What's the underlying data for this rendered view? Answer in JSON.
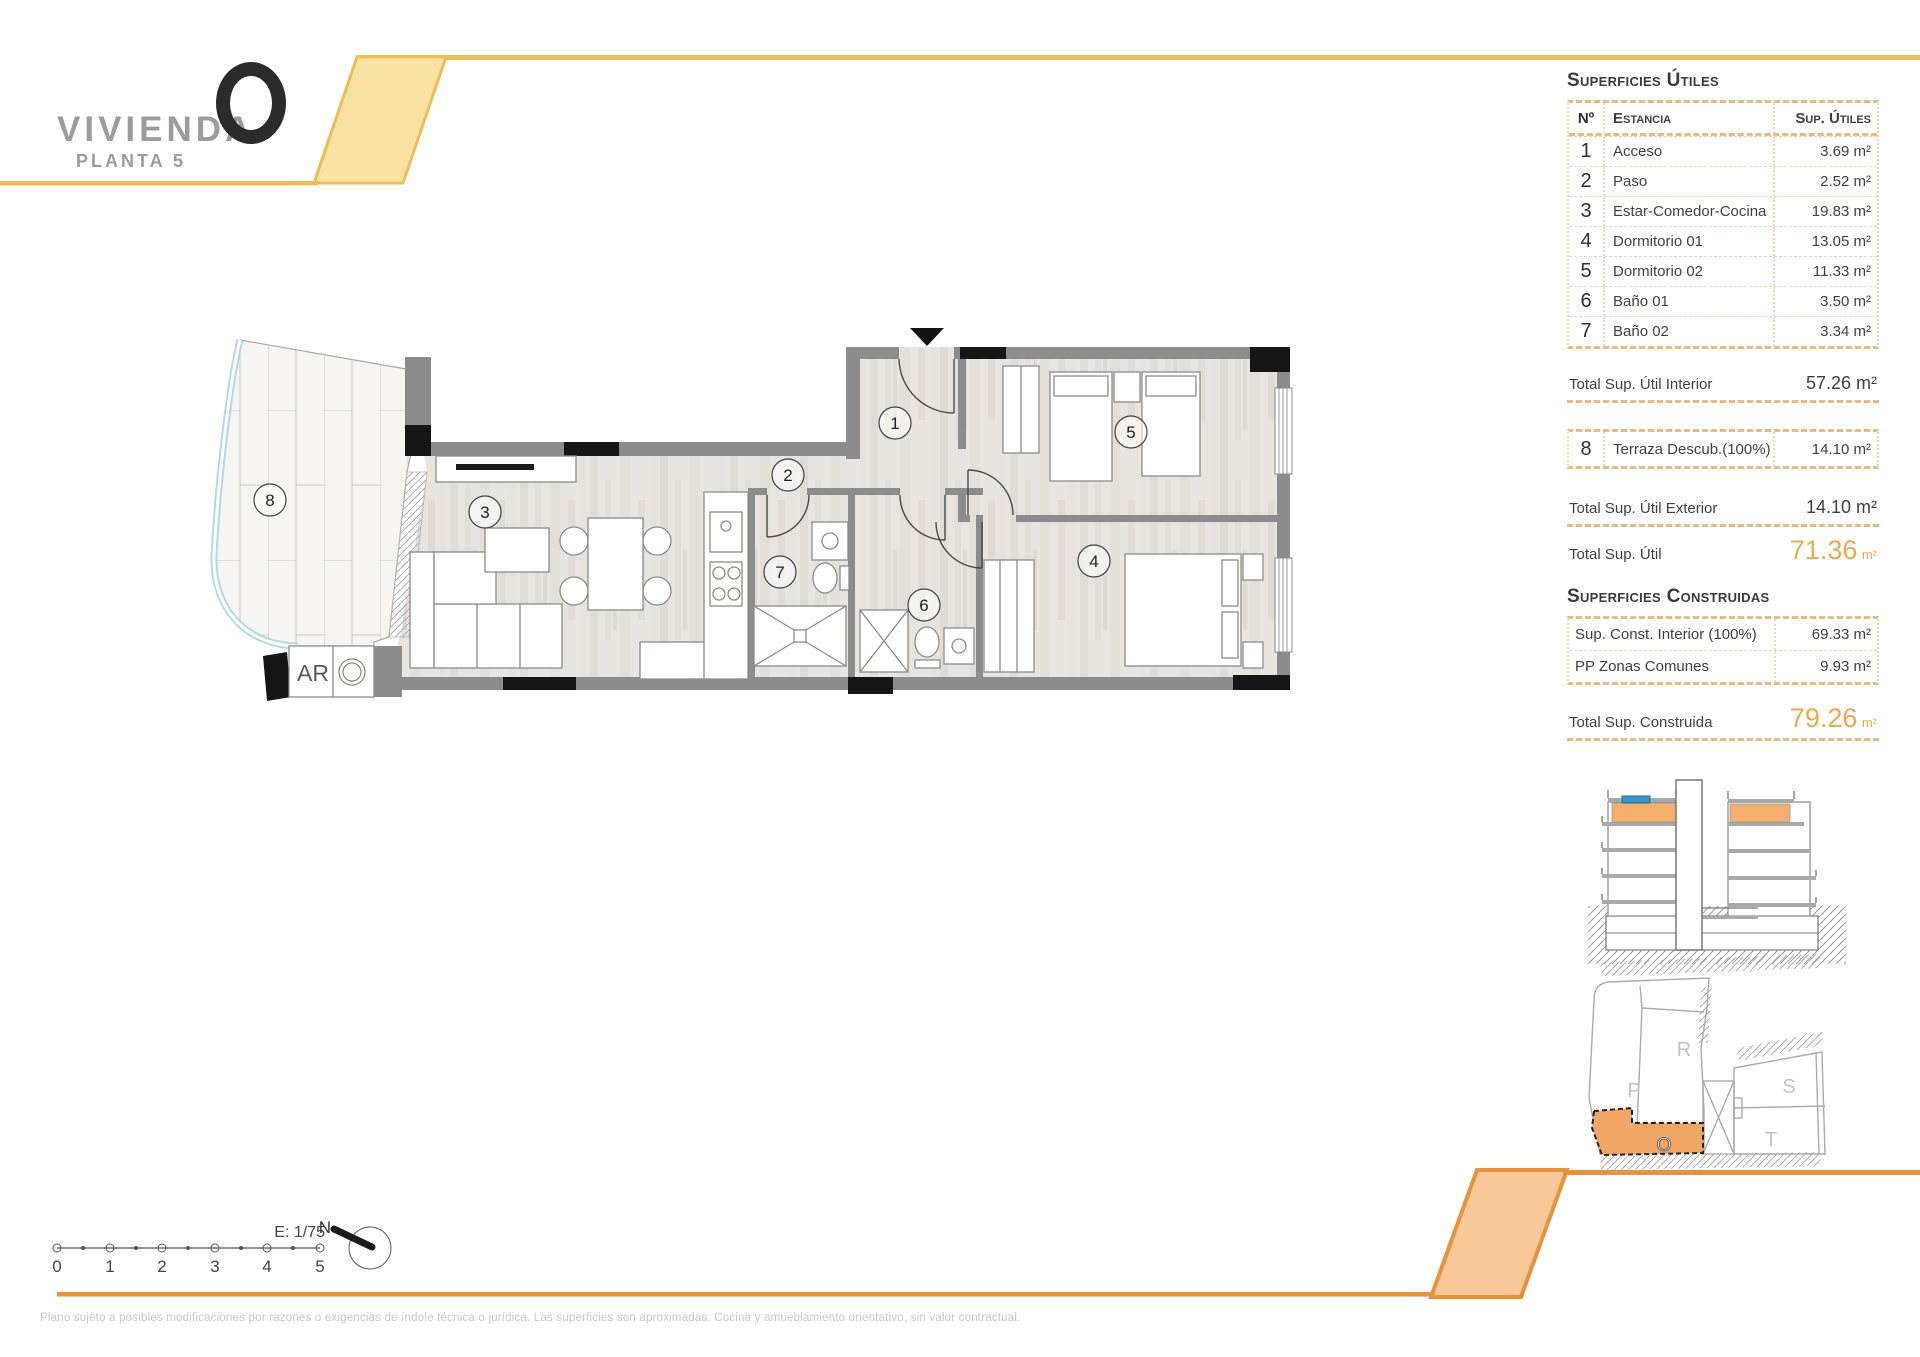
{
  "page_title": "Vivienda O - Planta 5",
  "header": {
    "brand": "VIVIENDA",
    "logo_letter": "O",
    "floor_label": "PLANTA 5"
  },
  "surfaces_utiles": {
    "title": "Superficies Útiles",
    "columns": {
      "num": "Nº",
      "room": "Estancia",
      "area": "Sup. Útiles"
    },
    "rows": [
      {
        "num": "1",
        "room": "Acceso",
        "area": "3.69 m²"
      },
      {
        "num": "2",
        "room": "Paso",
        "area": "2.52 m²"
      },
      {
        "num": "3",
        "room": "Estar-Comedor-Cocina",
        "area": "19.83 m²"
      },
      {
        "num": "4",
        "room": "Dormitorio 01",
        "area": "13.05 m²"
      },
      {
        "num": "5",
        "room": "Dormitorio 02",
        "area": "11.33 m²"
      },
      {
        "num": "6",
        "room": "Baño 01",
        "area": "3.50 m²"
      },
      {
        "num": "7",
        "room": "Baño 02",
        "area": "3.34 m²"
      }
    ],
    "total_interior": {
      "label": "Total Sup. Útil Interior",
      "value": "57.26 m²"
    },
    "terrace_row": {
      "num": "8",
      "room": "Terraza Descub.(100%)",
      "area": "14.10 m²"
    },
    "total_exterior": {
      "label": "Total Sup. Útil Exterior",
      "value": "14.10 m²"
    },
    "total": {
      "label": "Total Sup. Útil",
      "value": "71.36",
      "unit": "m²"
    }
  },
  "surfaces_construidas": {
    "title": "Superficies Construidas",
    "rows": [
      {
        "label": "Sup. Const. Interior (100%)",
        "value": "69.33 m²"
      },
      {
        "label": "PP Zonas Comunes",
        "value": "9.93 m²"
      }
    ],
    "total": {
      "label": "Total Sup. Construida",
      "value": "79.26",
      "unit": "m²"
    }
  },
  "plan": {
    "room_numbers": [
      "1",
      "2",
      "3",
      "4",
      "5",
      "6",
      "7",
      "8"
    ],
    "ar_label": "AR"
  },
  "site_plan": {
    "blocks": [
      "R",
      "P",
      "S",
      "T"
    ],
    "unit_letter": "O"
  },
  "scale_bar": {
    "label": "E: 1/75",
    "ticks": [
      "0",
      "1",
      "2",
      "3",
      "4",
      "5"
    ],
    "north_label": "N"
  },
  "footer": {
    "disclaimer": "Plano sujeto a posibles modificaciones por razones o exigencias de índole técnica o jurídica. Las superficies son aproximadas. Cocina y amueblamiento orientativo, sin valor contractual."
  },
  "colors": {
    "accent_yellow": "#ECBE55",
    "accent_yellow_fill": "#FAE3A2",
    "accent_orange": "#E8923B",
    "accent_orange_fill": "#F8C998",
    "highlight_text": "#EFA94A",
    "wall_gray": "#8C8C8C",
    "floor_tone": "#E7E4E0"
  }
}
